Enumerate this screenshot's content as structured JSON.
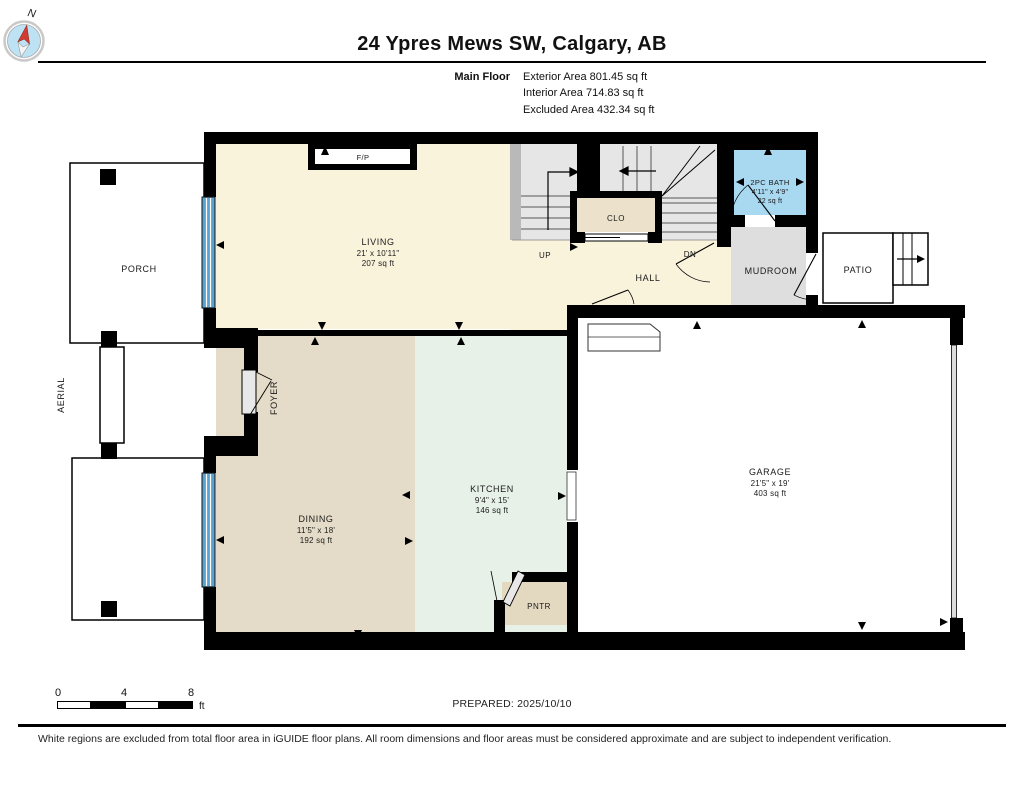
{
  "header": {
    "title": "24 Ypres Mews SW, Calgary, AB",
    "floor_label": "Main Floor",
    "area_lines": [
      "Exterior Area 801.45 sq ft",
      "Interior Area 714.83 sq ft",
      "Excluded Area 432.34 sq ft"
    ]
  },
  "rooms": {
    "living": {
      "label": "LIVING",
      "dims": "21' x 10'11\"",
      "area": "207 sq ft"
    },
    "dining": {
      "label": "DINING",
      "dims": "11'5\" x 18'",
      "area": "192 sq ft"
    },
    "kitchen": {
      "label": "KITCHEN",
      "dims": "9'4\" x 15'",
      "area": "146 sq ft"
    },
    "garage": {
      "label": "GARAGE",
      "dims": "21'5\" x 19'",
      "area": "403 sq ft"
    },
    "bath": {
      "label": "2PC BATH",
      "dims": "4'11\" x 4'9\"",
      "area": "22 sq ft"
    },
    "hall": {
      "label": "HALL"
    },
    "mudroom": {
      "label": "MUDROOM"
    },
    "foyer": {
      "label": "FOYER"
    },
    "porch": {
      "label": "PORCH"
    },
    "patio": {
      "label": "PATIO"
    },
    "pantry": {
      "label": "PNTR"
    },
    "closet": {
      "label": "CLO"
    },
    "aerial": {
      "label": "AERIAL"
    },
    "fireplace": {
      "label": "F/P"
    },
    "stairs_up": {
      "label": "UP"
    },
    "stairs_down": {
      "label": "DN"
    }
  },
  "colors": {
    "living": "#FAF3DC",
    "dining": "#E4DCC8",
    "kitchen": "#E7F1E8",
    "bath": "#A9D8F1",
    "mudroom": "#DEDEDE",
    "stairs": "#E6E6E6",
    "stair_halfwall": "#B9B9B9",
    "closet": "#ECE2CC",
    "pantry": "#E3D9C1",
    "window": "#5BA3CF",
    "wall": "#000000",
    "compass_face": "#BDE2F4",
    "compass_needle": "#D23B2F"
  },
  "footer": {
    "scale_ticks": [
      "0",
      "4",
      "8"
    ],
    "scale_unit": "ft",
    "prepared": "PREPARED: 2025/10/10",
    "compass_north": "N",
    "disclaimer": "White regions are excluded from total floor area in iGUIDE floor plans. All room dimensions and floor areas must be considered approximate and are subject to independent verification."
  }
}
